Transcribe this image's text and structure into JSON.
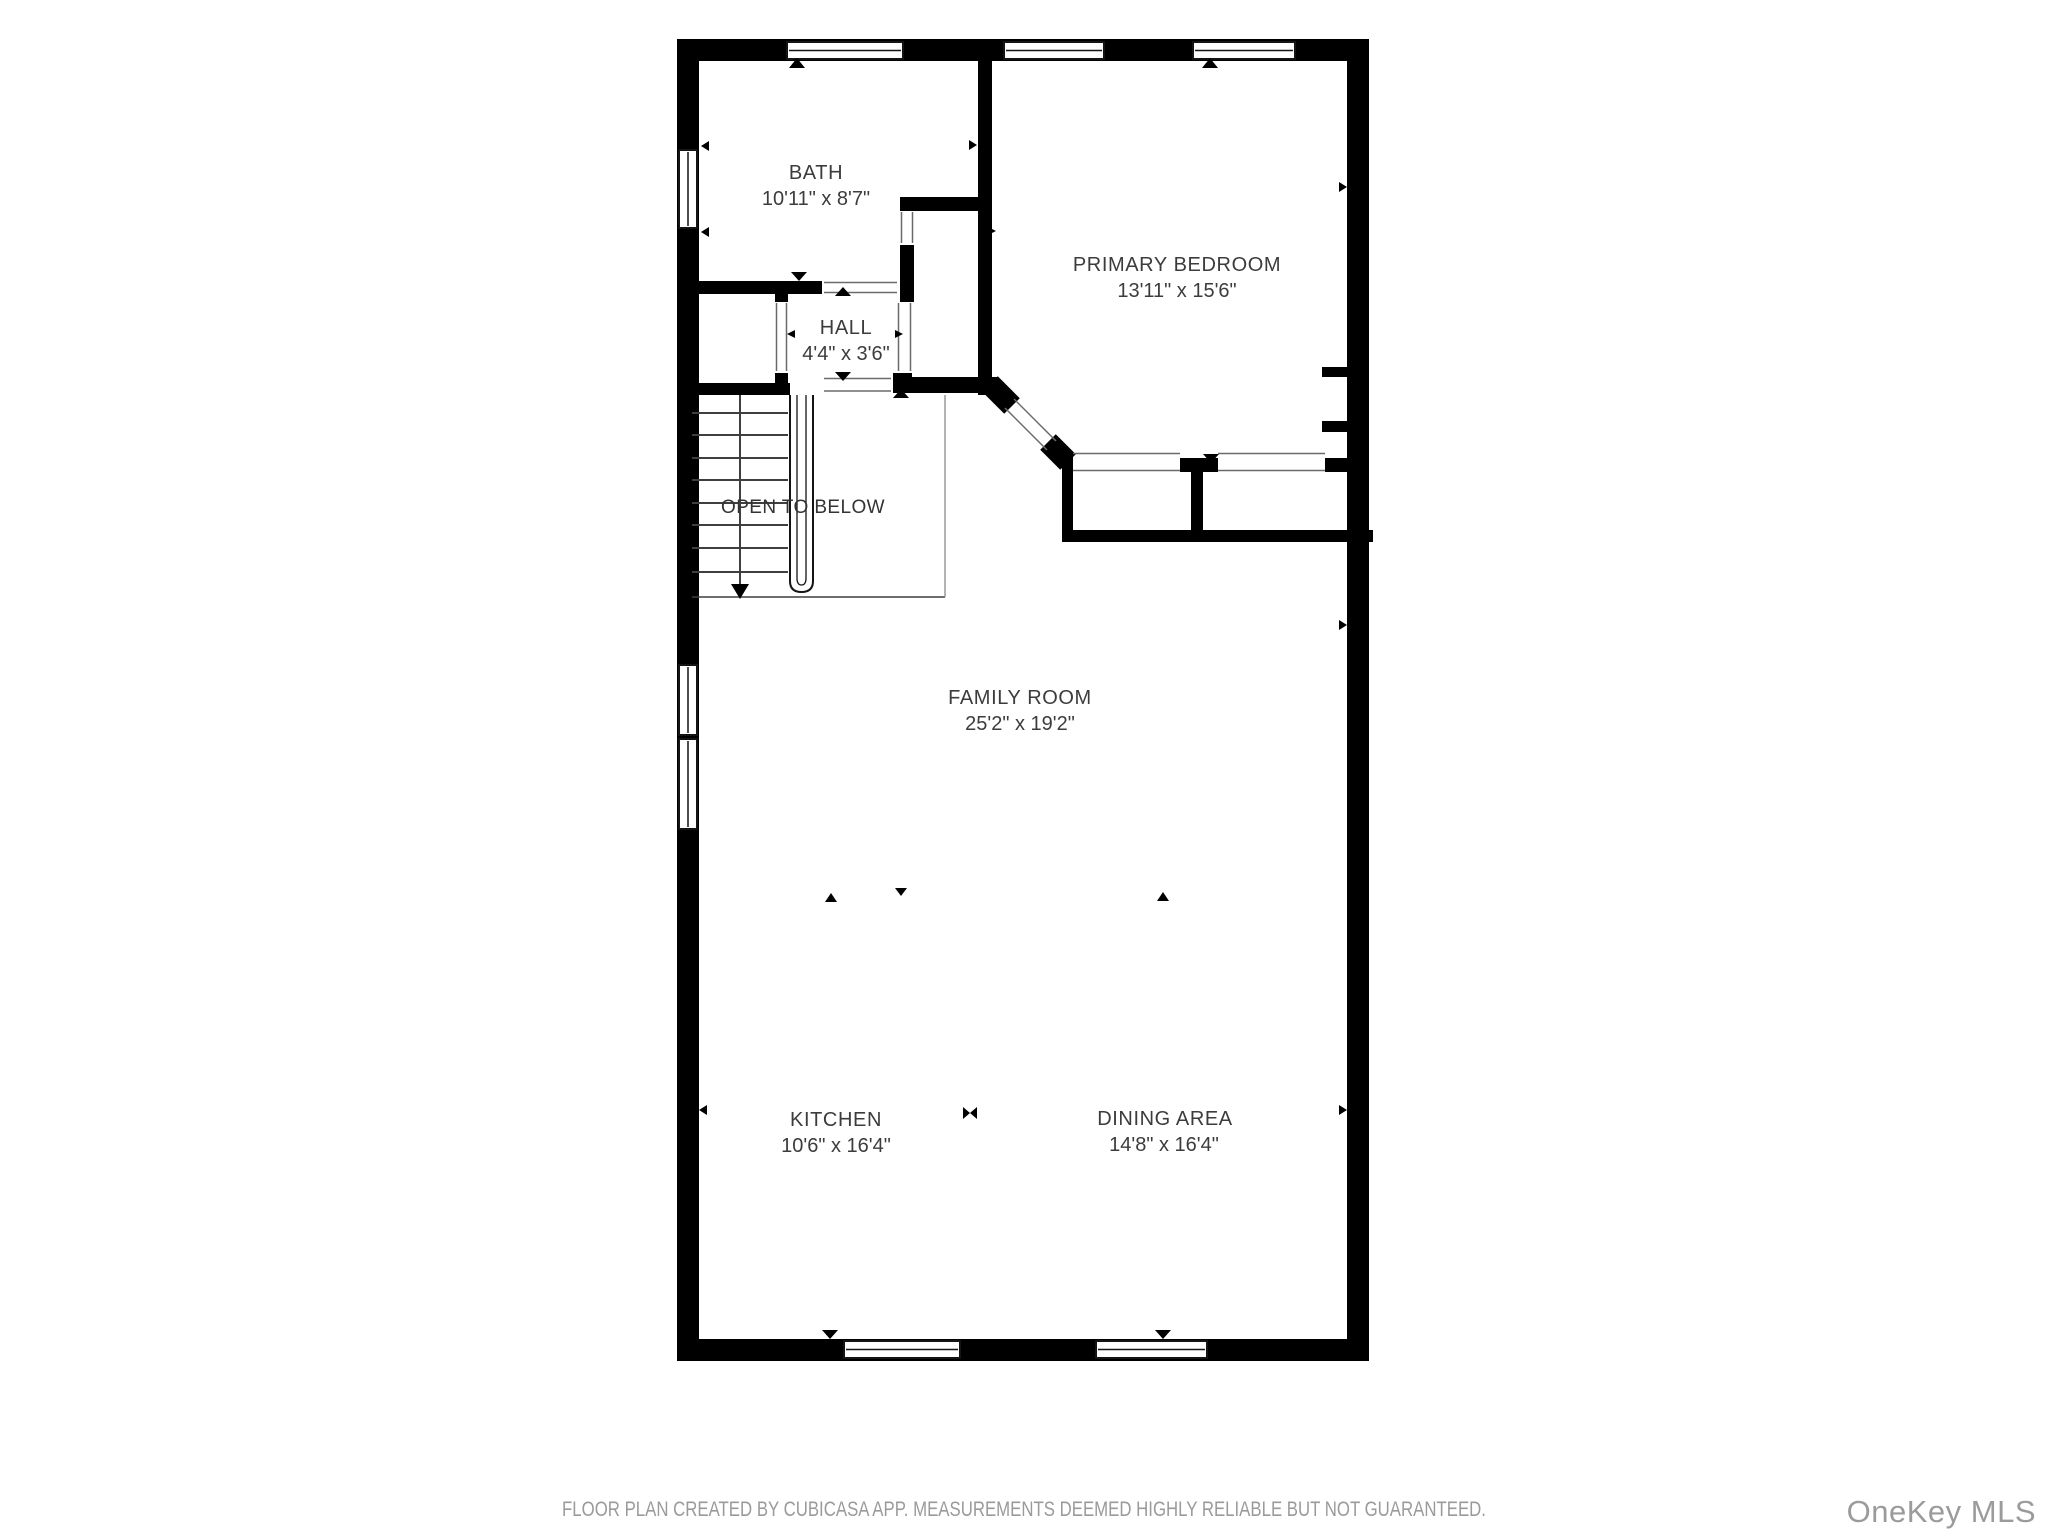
{
  "plan": {
    "creator_note": "FLOOR PLAN CREATED BY CUBICASA APP. MEASUREMENTS DEEMED HIGHLY RELIABLE BUT NOT GUARANTEED.",
    "watermark": "OneKey MLS"
  },
  "rooms": [
    {
      "name": "BATH",
      "dims": "10'11\" x 8'7\""
    },
    {
      "name": "PRIMARY BEDROOM",
      "dims": "13'11\" x 15'6\""
    },
    {
      "name": "HALL",
      "dims": "4'4\" x 3'6\""
    },
    {
      "name": "FAMILY ROOM",
      "dims": "25'2\" x 19'2\""
    },
    {
      "name": "KITCHEN",
      "dims": "10'6\" x 16'4\""
    },
    {
      "name": "DINING AREA",
      "dims": "14'8\" x 16'4\""
    }
  ],
  "annotations": {
    "open_to_below": "OPEN TO BELOW"
  },
  "colors": {
    "wall": "#000000",
    "stair_line": "#3f3f3f",
    "threshold_line": "#6a6a6a",
    "label_text": "#3c3c3c",
    "muted_text": "#9a9a9a",
    "background": "#ffffff"
  }
}
